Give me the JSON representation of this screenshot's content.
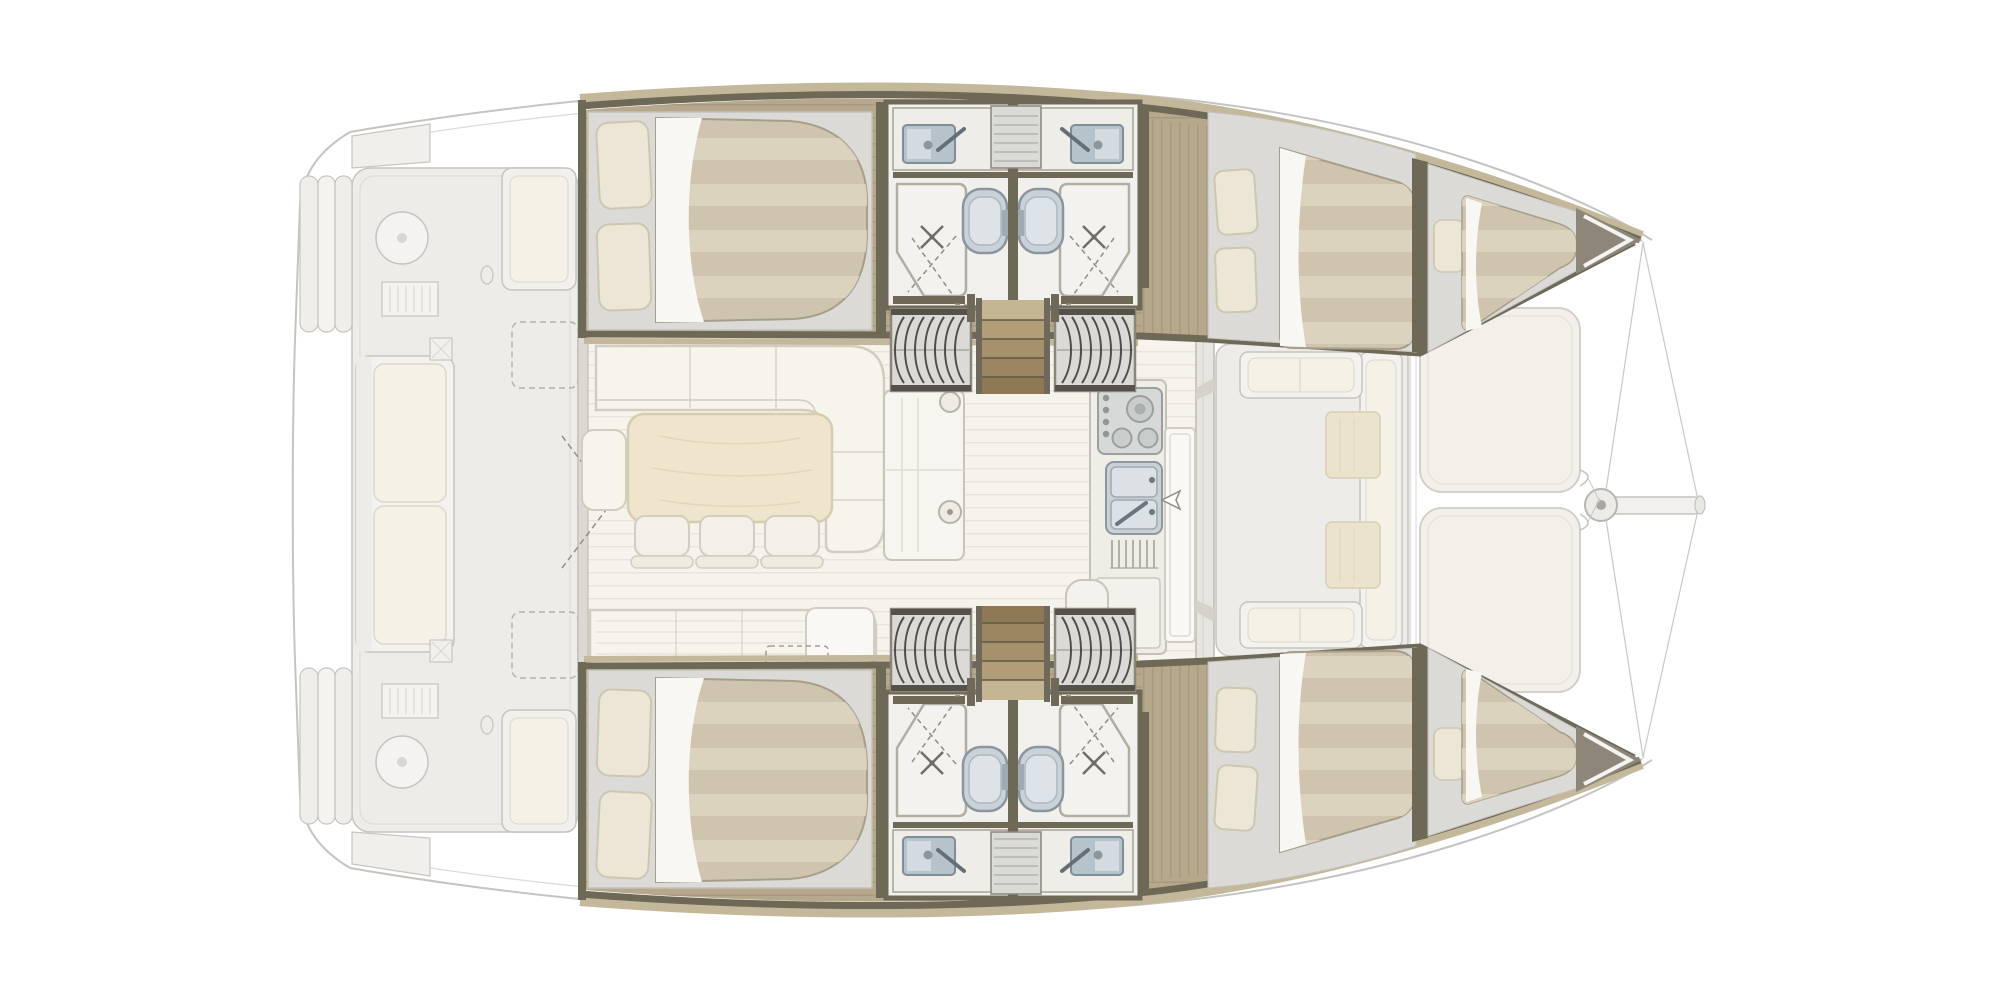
{
  "diagram": {
    "type": "floorplan",
    "subject": "catamaran-yacht-interior-layout",
    "view": "top-down",
    "orientation": {
      "bow": "right",
      "stern": "left"
    },
    "highlighted_zone": "accommodation-deck",
    "ghosted_zones": [
      "aft-cockpit",
      "side-decks",
      "forward-cockpit",
      "foredeck-sunpads",
      "bowsprit"
    ],
    "port_hull": {
      "rooms": [
        "aft-double-cabin",
        "bathroom-aft",
        "bathroom-forward",
        "companionway-stairs",
        "forward-double-cabin",
        "forepeak-berth"
      ],
      "bathroom_fixtures": [
        "sink",
        "faucet",
        "toilet",
        "shower-tray",
        "folding-shower-door"
      ]
    },
    "starboard_hull": {
      "rooms": [
        "aft-double-cabin",
        "bathroom-aft",
        "bathroom-forward",
        "companionway-stairs",
        "forward-double-cabin",
        "forepeak-berth"
      ],
      "bathroom_fixtures": [
        "sink",
        "faucet",
        "toilet",
        "shower-tray",
        "folding-shower-door"
      ]
    },
    "main_deck": {
      "rooms": [
        "salon",
        "galley",
        "forward-cockpit",
        "aft-cockpit",
        "foredeck"
      ],
      "salon_furniture": [
        "l-shaped-sofa",
        "dining-table",
        "stool",
        "stool",
        "stool",
        "end-seat",
        "settee",
        "sideboard-cabinet"
      ],
      "galley_fixtures": [
        "stove-with-burners",
        "double-sink",
        "faucet",
        "drainer",
        "counter"
      ],
      "forward_cockpit_furniture": [
        "u-shaped-bench",
        "cocktail-table",
        "cocktail-table"
      ],
      "aft_cockpit_furniture": [
        "long-bench-sofa",
        "lounge-module",
        "lounge-module",
        "helm-circle",
        "helm-circle",
        "grill-locker",
        "grill-locker"
      ],
      "foredeck_items": [
        "sunpad",
        "sunpad",
        "anchor-roller",
        "bowsprit",
        "rigging-lines"
      ]
    },
    "counts": {
      "double_cabins": 4,
      "forepeak_berths": 2,
      "bathrooms": 4,
      "toilets": 4,
      "showers": 4,
      "bathroom_sinks": 4,
      "companionway_stairs": 2,
      "tambour_stair_covers": 4,
      "dining_stools": 3,
      "sunpads": 2
    }
  },
  "palette": {
    "ghost_stroke": "#c6c4c0",
    "ghost_stroke_light": "#dcdad6",
    "ghost_fill": "#f3f2ef",
    "ghost_fill2": "#edece9",
    "ghost_cushion": "#f5f1e6",
    "ghost_cushion_stroke": "#ddd8cb",
    "ghost_wood": "#ece3cd",
    "ghost_wood_stroke": "#d8cfb9",
    "wall_dark": "#6e6857",
    "wall_tan": "#c4b89a",
    "wall_gray": "#8b867c",
    "wood": "#b6a88b",
    "wood_line": "#a3957a",
    "platform": "#dbdad6",
    "platform_line": "#c2c1bc",
    "duvet": "#cfc5ae",
    "duvet_light": "#dcd4c0",
    "duvet_stroke": "#a79e8a",
    "sheet": "#f8f7f3",
    "pillow": "#ece6d6",
    "pillow_stroke": "#cfc6b0",
    "bath": "#f1f0ec",
    "steel": "#b7c3cb",
    "steel_dark": "#7e8d97",
    "steel_light": "#d2dbe0",
    "porcelain": "#c9d2d8",
    "porcelain_dark": "#8a969f",
    "tambour": "#dbdad6",
    "tambour_slat": "#4f4d48",
    "frame_gray": "#8b867c",
    "stair1": "#c4b593",
    "stair2": "#b19e78",
    "stair3": "#a5916b",
    "stair4": "#99855f",
    "stair5": "#8d7953",
    "stair_rail": "#6f695c",
    "salon_floor": "#f6f3ed",
    "salon_line": "#eae4d8",
    "sofa": "#f7f4ec",
    "sofa_stroke": "#d2cdc0",
    "table": "#eee5cc",
    "table_stroke": "#d7ccae",
    "stool": "#f3f0e7",
    "cab_white": "#f9f8f4",
    "steelg": "#d7d9d8",
    "steelg_dark": "#9aa09e",
    "bow_solid": "#8d8679",
    "dash_line": "#948f84"
  }
}
